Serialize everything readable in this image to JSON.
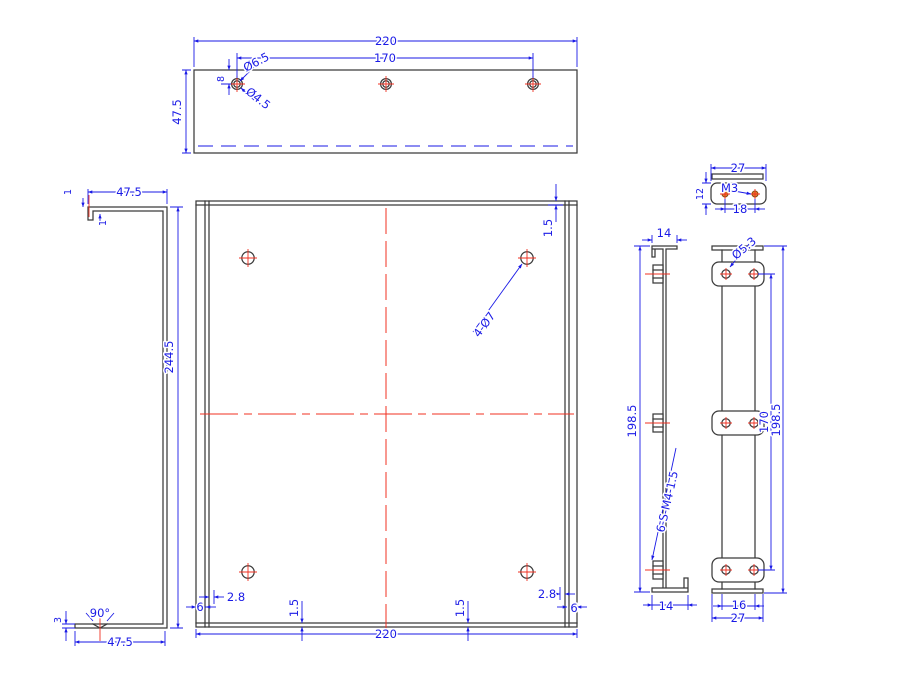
{
  "drawing": {
    "background": "#ffffff",
    "colors": {
      "outline": "#3b3b3b",
      "dimension": "#1a1ae6",
      "centerline": "#f03022",
      "tapped_hole_fill": "#e0812a"
    },
    "top_view": {
      "width": "220",
      "hole_span": "170",
      "depth": "47.5",
      "hole_edge_offset": "8",
      "csk_dia": "Ø6.5",
      "hole_dia": "Ø4.5"
    },
    "side_view": {
      "flange_top": "47.5",
      "hem_a": "1",
      "hem_b": "1",
      "height": "244.5",
      "csk_angle": "90°",
      "tip_height": "3",
      "flange_bottom": "47.5"
    },
    "front_view": {
      "bend_top": "1.5",
      "holes": "4-Ø7",
      "edge_left": "6",
      "offset_left": "2.8",
      "bend_left": "1.5",
      "bend_right": "1.5",
      "offset_right": "2.8",
      "edge_right": "6",
      "width": "220"
    },
    "bracket_view": {
      "width": "27",
      "height": "12",
      "thread": "M3",
      "hole_span": "18"
    },
    "rail_side_view": {
      "flange_top": "14",
      "length": "198.5",
      "standoff": "6-S-M4-1.5",
      "flange_bottom": "14"
    },
    "rail_face_view": {
      "hole_dia": "Ø5.3",
      "hole_span": "170",
      "length": "198.5",
      "width_inner": "16",
      "width_outer": "27"
    }
  }
}
